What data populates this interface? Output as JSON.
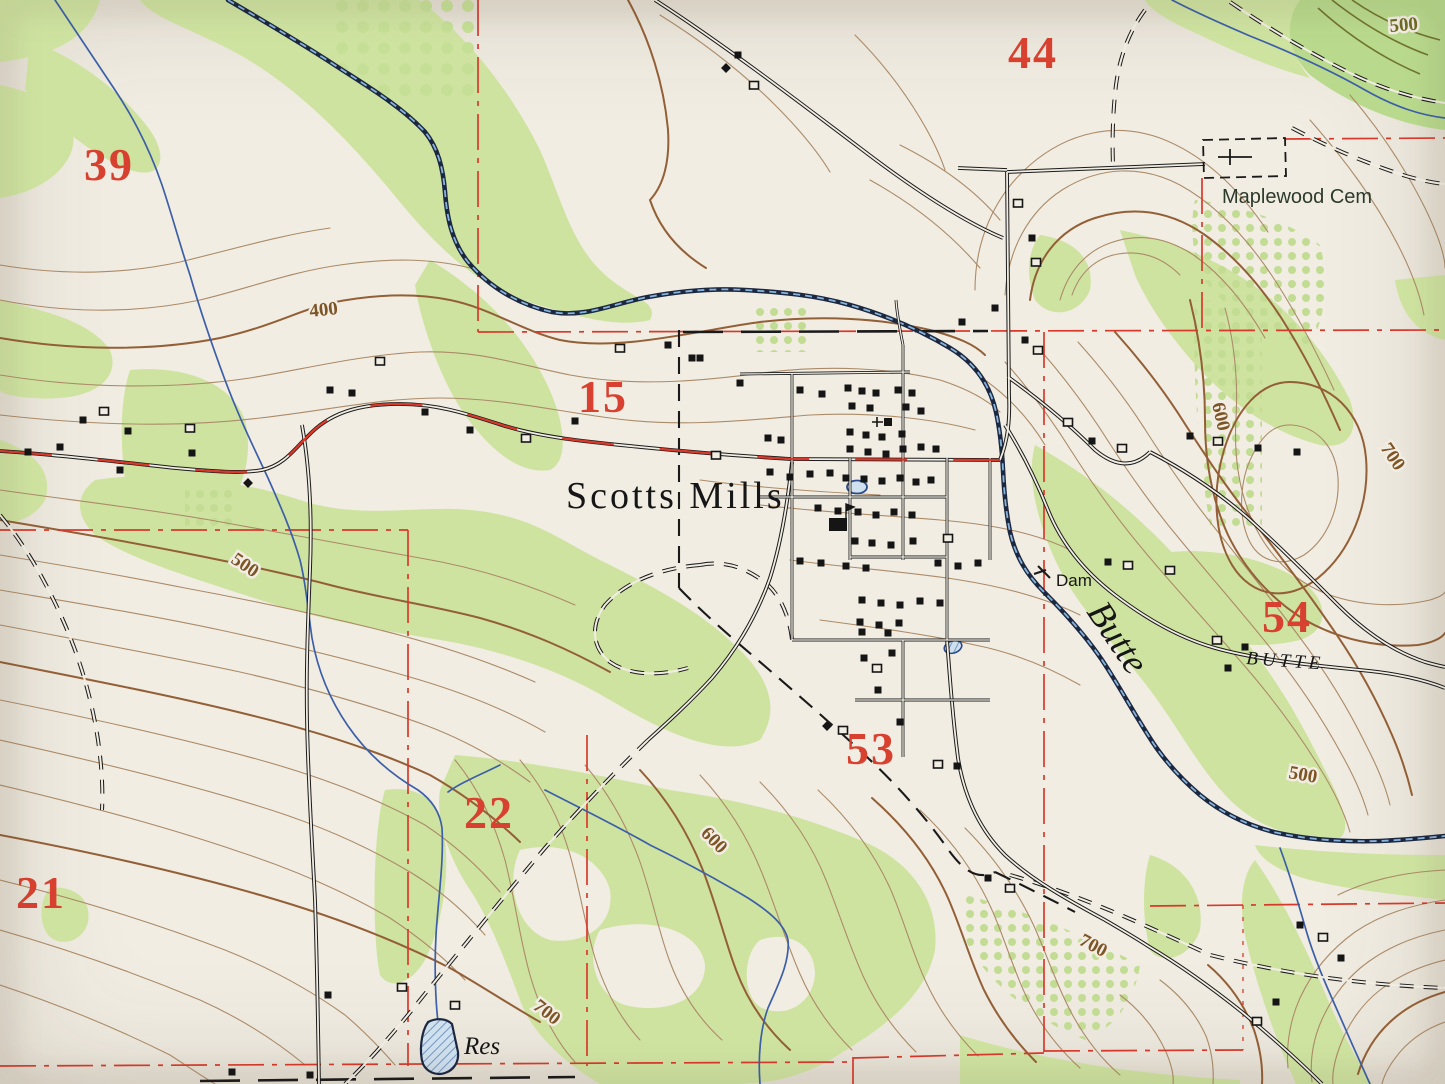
{
  "map": {
    "kind": "topographic-quad-photo",
    "place": "Scotts Mills",
    "colors": {
      "paper": "#f1ede3",
      "woodland": "#cfe3a1",
      "contour": "#935f36",
      "contour_light": "#ab8b68",
      "water": "#3c5fa8",
      "creek_dark": "#1c2740",
      "red_overprint": "#d9392b",
      "black_ink": "#1a1a1a"
    },
    "section_numbers": [
      {
        "label": "39",
        "x": 84,
        "y": 180
      },
      {
        "label": "44",
        "x": 1008,
        "y": 68
      },
      {
        "label": "15",
        "x": 578,
        "y": 412
      },
      {
        "label": "54",
        "x": 1262,
        "y": 632
      },
      {
        "label": "53",
        "x": 846,
        "y": 764
      },
      {
        "label": "22",
        "x": 464,
        "y": 828
      },
      {
        "label": "21",
        "x": 16,
        "y": 908
      }
    ],
    "place_labels": [
      {
        "id": "town-name",
        "text": "Scotts Mills",
        "x": 566,
        "y": 508,
        "rot": 0,
        "cls": "lbl-place"
      },
      {
        "id": "cemetery-name",
        "text": "Maplewood Cem",
        "x": 1222,
        "y": 203,
        "rot": 0,
        "cls": "lbl-sans"
      },
      {
        "id": "dam-label",
        "text": "Dam",
        "x": 1056,
        "y": 586,
        "rot": 0,
        "cls": "lbl-dam"
      },
      {
        "id": "creek-name",
        "text": "Butte",
        "x": 1086,
        "y": 612,
        "rot": 56,
        "cls": "lbl-ital"
      },
      {
        "id": "butte-road",
        "text": "BUTTE",
        "x": 1246,
        "y": 664,
        "rot": 4,
        "cls": "lbl-caps"
      },
      {
        "id": "reservoir-name",
        "text": "Res",
        "x": 464,
        "y": 1054,
        "rot": 0,
        "cls": "lbl-res"
      }
    ],
    "contour_labels": [
      {
        "text": "400",
        "x": 310,
        "y": 317,
        "rot": -6
      },
      {
        "text": "500",
        "x": 230,
        "y": 562,
        "rot": 34
      },
      {
        "text": "500",
        "x": 1390,
        "y": 32,
        "rot": -5,
        "olive": true
      },
      {
        "text": "600",
        "x": 700,
        "y": 834,
        "rot": 46
      },
      {
        "text": "700",
        "x": 532,
        "y": 1008,
        "rot": 38
      },
      {
        "text": "700",
        "x": 1078,
        "y": 944,
        "rot": 28
      },
      {
        "text": "500",
        "x": 1288,
        "y": 778,
        "rot": 10
      },
      {
        "text": "600",
        "x": 1212,
        "y": 404,
        "rot": 77
      },
      {
        "text": "700",
        "x": 1380,
        "y": 448,
        "rot": 56
      }
    ],
    "buildings": [
      [
        28,
        452,
        "f"
      ],
      [
        60,
        447,
        "f"
      ],
      [
        83,
        420,
        "f"
      ],
      [
        104,
        411,
        "h"
      ],
      [
        128,
        431,
        "f"
      ],
      [
        120,
        470,
        "f"
      ],
      [
        192,
        453,
        "f"
      ],
      [
        190,
        428,
        "h"
      ],
      [
        248,
        483,
        "d"
      ],
      [
        330,
        390,
        "f"
      ],
      [
        352,
        393,
        "f"
      ],
      [
        380,
        361,
        "h"
      ],
      [
        425,
        412,
        "f"
      ],
      [
        470,
        430,
        "f"
      ],
      [
        526,
        438,
        "h"
      ],
      [
        575,
        421,
        "f"
      ],
      [
        620,
        348,
        "h"
      ],
      [
        668,
        345,
        "f"
      ],
      [
        692,
        358,
        "f"
      ],
      [
        716,
        455,
        "h"
      ],
      [
        738,
        55,
        "f"
      ],
      [
        726,
        68,
        "d"
      ],
      [
        754,
        85,
        "h"
      ],
      [
        1018,
        203,
        "h"
      ],
      [
        1032,
        238,
        "f"
      ],
      [
        1036,
        262,
        "h"
      ],
      [
        995,
        308,
        "f"
      ],
      [
        962,
        322,
        "f"
      ],
      [
        1025,
        340,
        "f"
      ],
      [
        1038,
        350,
        "h"
      ],
      [
        700,
        358,
        "f"
      ],
      [
        740,
        383,
        "f"
      ],
      [
        800,
        390,
        "f"
      ],
      [
        822,
        394,
        "f"
      ],
      [
        848,
        388,
        "f"
      ],
      [
        862,
        391,
        "f"
      ],
      [
        876,
        393,
        "f"
      ],
      [
        898,
        390,
        "f"
      ],
      [
        912,
        393,
        "f"
      ],
      [
        852,
        406,
        "f"
      ],
      [
        870,
        408,
        "f"
      ],
      [
        906,
        407,
        "f"
      ],
      [
        921,
        411,
        "f"
      ],
      [
        888,
        422,
        "c"
      ],
      [
        768,
        438,
        "f"
      ],
      [
        781,
        440,
        "f"
      ],
      [
        850,
        432,
        "f"
      ],
      [
        866,
        435,
        "f"
      ],
      [
        882,
        437,
        "f"
      ],
      [
        902,
        434,
        "f"
      ],
      [
        850,
        449,
        "f"
      ],
      [
        868,
        452,
        "f"
      ],
      [
        886,
        454,
        "f"
      ],
      [
        903,
        449,
        "f"
      ],
      [
        921,
        447,
        "f"
      ],
      [
        936,
        449,
        "f"
      ],
      [
        770,
        472,
        "f"
      ],
      [
        790,
        477,
        "f"
      ],
      [
        810,
        474,
        "f"
      ],
      [
        830,
        473,
        "f"
      ],
      [
        846,
        478,
        "f"
      ],
      [
        864,
        479,
        "f"
      ],
      [
        882,
        481,
        "f"
      ],
      [
        900,
        478,
        "f"
      ],
      [
        916,
        482,
        "f"
      ],
      [
        931,
        480,
        "f"
      ],
      [
        818,
        508,
        "f"
      ],
      [
        838,
        511,
        "f"
      ],
      [
        858,
        512,
        "f"
      ],
      [
        876,
        515,
        "f"
      ],
      [
        894,
        512,
        "f"
      ],
      [
        912,
        515,
        "f"
      ],
      [
        838,
        524,
        "L"
      ],
      [
        855,
        541,
        "f"
      ],
      [
        872,
        543,
        "f"
      ],
      [
        891,
        545,
        "f"
      ],
      [
        913,
        541,
        "f"
      ],
      [
        948,
        538,
        "h"
      ],
      [
        800,
        561,
        "f"
      ],
      [
        821,
        563,
        "f"
      ],
      [
        846,
        566,
        "f"
      ],
      [
        866,
        568,
        "f"
      ],
      [
        938,
        563,
        "f"
      ],
      [
        958,
        566,
        "f"
      ],
      [
        978,
        563,
        "f"
      ],
      [
        862,
        600,
        "f"
      ],
      [
        881,
        603,
        "f"
      ],
      [
        900,
        605,
        "f"
      ],
      [
        920,
        601,
        "f"
      ],
      [
        940,
        603,
        "f"
      ],
      [
        860,
        622,
        "f"
      ],
      [
        879,
        625,
        "f"
      ],
      [
        899,
        623,
        "f"
      ],
      [
        862,
        632,
        "f"
      ],
      [
        888,
        633,
        "f"
      ],
      [
        864,
        658,
        "f"
      ],
      [
        892,
        653,
        "f"
      ],
      [
        877,
        668,
        "h"
      ],
      [
        878,
        690,
        "f"
      ],
      [
        900,
        722,
        "f"
      ],
      [
        827,
        726,
        "d"
      ],
      [
        843,
        730,
        "h"
      ],
      [
        957,
        766,
        "f"
      ],
      [
        938,
        764,
        "h"
      ],
      [
        988,
        878,
        "f"
      ],
      [
        1010,
        888,
        "h"
      ],
      [
        1068,
        422,
        "h"
      ],
      [
        1092,
        441,
        "f"
      ],
      [
        1122,
        448,
        "h"
      ],
      [
        1190,
        436,
        "f"
      ],
      [
        1218,
        441,
        "h"
      ],
      [
        1258,
        448,
        "f"
      ],
      [
        1297,
        452,
        "f"
      ],
      [
        1108,
        562,
        "f"
      ],
      [
        1128,
        565,
        "h"
      ],
      [
        1170,
        570,
        "h"
      ],
      [
        1217,
        640,
        "h"
      ],
      [
        1245,
        647,
        "f"
      ],
      [
        1228,
        668,
        "f"
      ],
      [
        1300,
        925,
        "f"
      ],
      [
        1323,
        937,
        "h"
      ],
      [
        1341,
        958,
        "f"
      ],
      [
        1276,
        1002,
        "f"
      ],
      [
        1257,
        1021,
        "h"
      ],
      [
        328,
        995,
        "f"
      ],
      [
        402,
        987,
        "h"
      ],
      [
        455,
        1005,
        "h"
      ],
      [
        310,
        1075,
        "f"
      ],
      [
        232,
        1072,
        "f"
      ]
    ],
    "water_features": [
      "Butte Creek",
      "Dam",
      "Res",
      "two small ponds",
      "tributary streams"
    ]
  }
}
